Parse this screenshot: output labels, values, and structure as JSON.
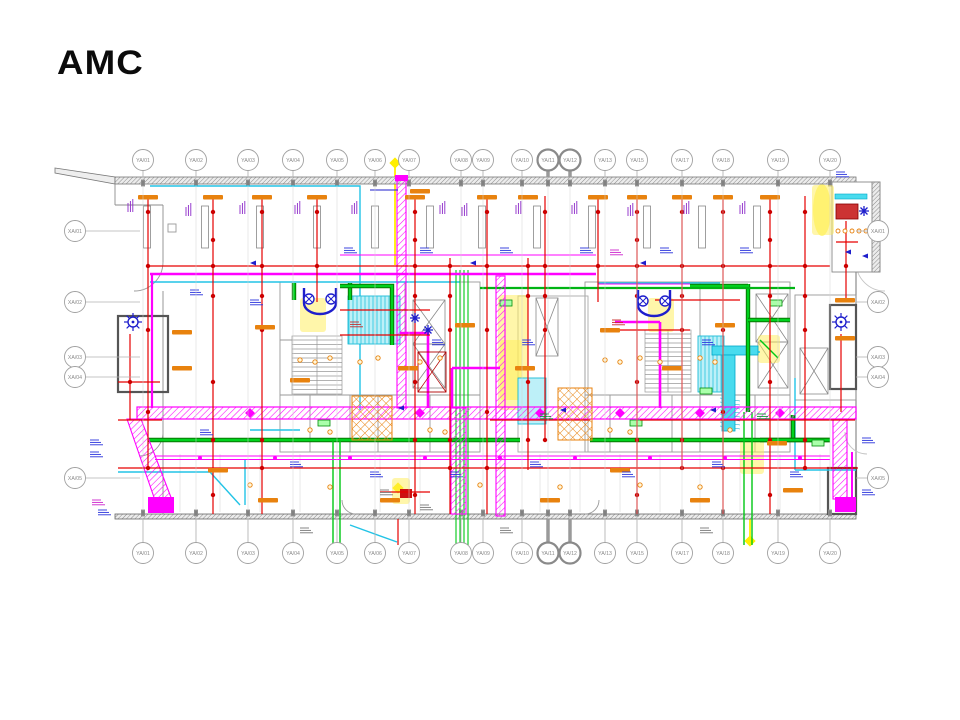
{
  "slide": {
    "background": "#ffffff",
    "logo_text": "AMC"
  },
  "drawing": {
    "grid": {
      "column_bubble_y_top": 160,
      "column_bubble_y_bottom": 553,
      "row_bubble_x_left": 75,
      "row_bubble_x_right": 878,
      "columns": [
        {
          "label": "YA/01",
          "x": 143
        },
        {
          "label": "YA/02",
          "x": 196
        },
        {
          "label": "YA/03",
          "x": 248
        },
        {
          "label": "YA/04",
          "x": 293
        },
        {
          "label": "YA/05",
          "x": 337
        },
        {
          "label": "YA/06",
          "x": 375
        },
        {
          "label": "YA/07",
          "x": 409
        },
        {
          "label": "YA/08",
          "x": 461
        },
        {
          "label": "YA/09",
          "x": 483
        },
        {
          "label": "YA/10",
          "x": 522
        },
        {
          "label": "YA/11",
          "x": 548,
          "highlight": true
        },
        {
          "label": "YA/12",
          "x": 570,
          "highlight": true
        },
        {
          "label": "YA/13",
          "x": 605
        },
        {
          "label": "YA/15",
          "x": 637
        },
        {
          "label": "YA/17",
          "x": 682
        },
        {
          "label": "YA/18",
          "x": 723
        },
        {
          "label": "YA/19",
          "x": 778
        },
        {
          "label": "YA/20",
          "x": 830
        }
      ],
      "rows": [
        {
          "label": "XA/01",
          "y": 231
        },
        {
          "label": "XA/02",
          "y": 302
        },
        {
          "label": "XA/03",
          "y": 357
        },
        {
          "label": "XA/04",
          "y": 377
        },
        {
          "label": "XA/05",
          "y": 478
        }
      ]
    },
    "palette": {
      "red": "#e60000",
      "dark_red": "#cc0000",
      "magenta": "#ff00ff",
      "green": "#00c814",
      "cyan": "#22c3e6",
      "blue": "#1e1ecc",
      "orange": "#e8820e",
      "yellow": "#ffee00",
      "wall_gray": "#8c8c8c",
      "grid_gray": "#a0a0a0"
    }
  }
}
